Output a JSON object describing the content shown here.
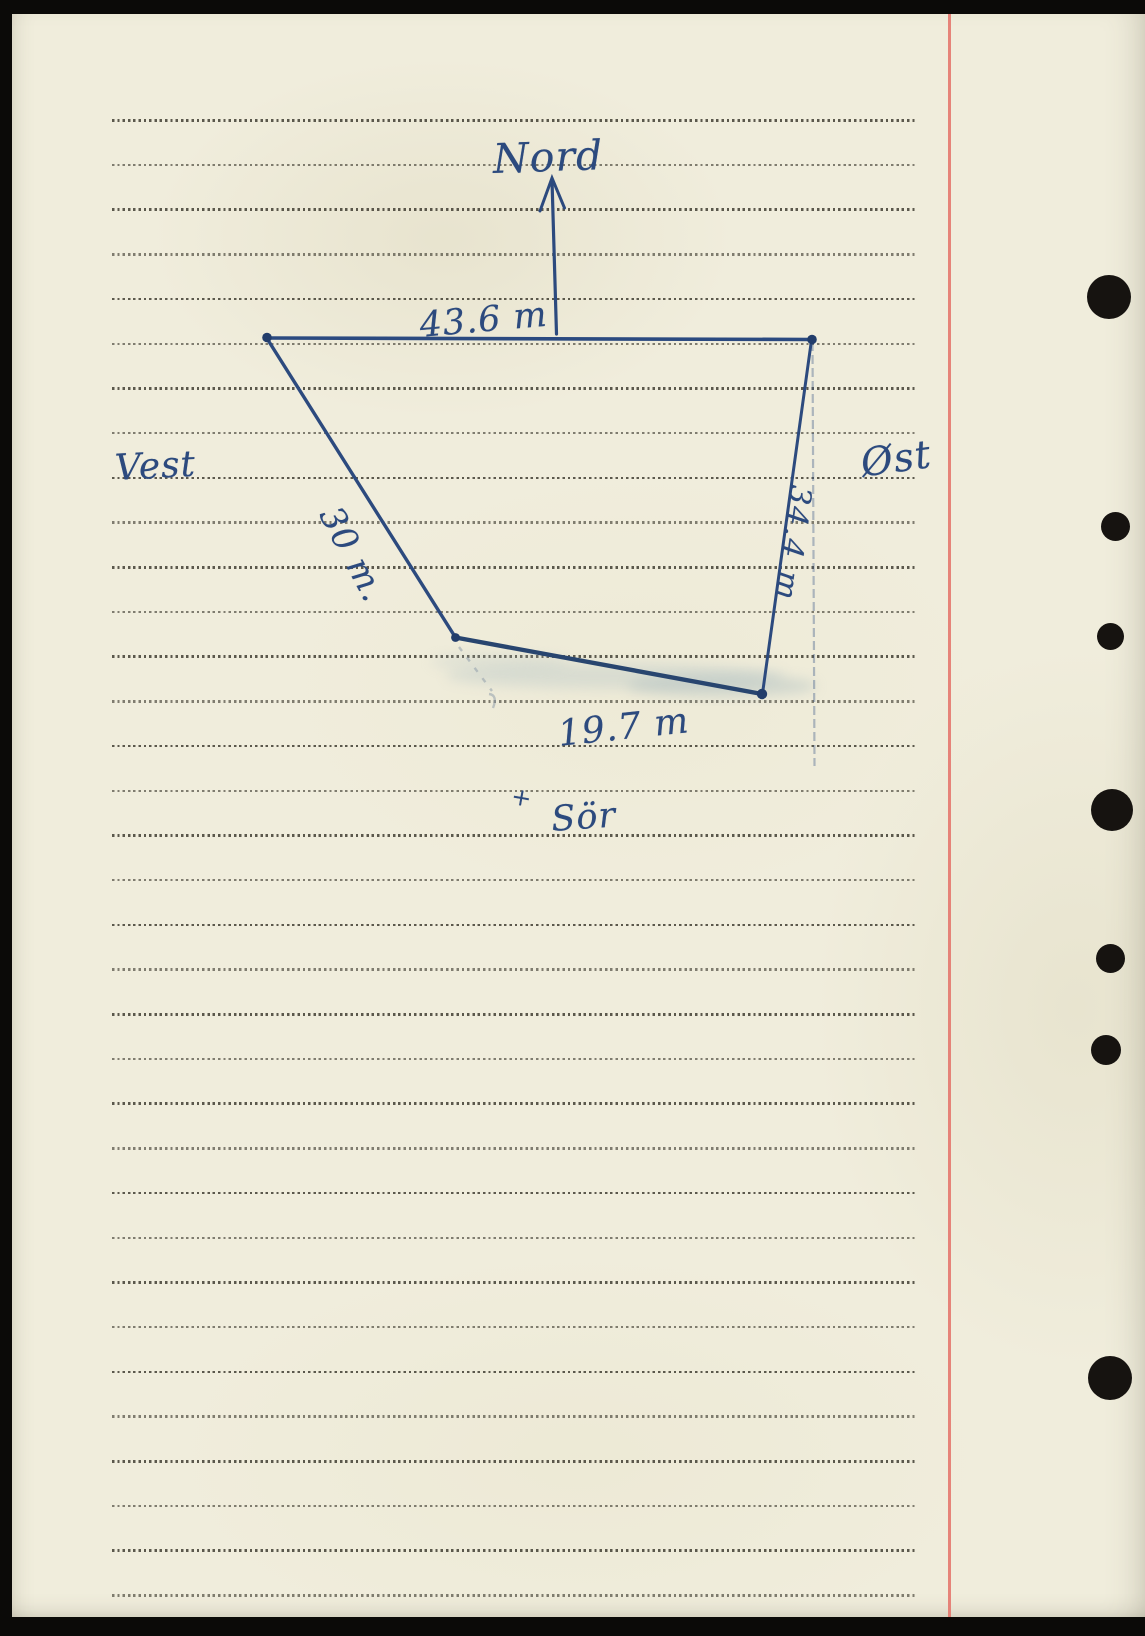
{
  "colors": {
    "paper": "#f0eddc",
    "ink": "#2c4a7e",
    "ink-dark": "#223d6b",
    "rule": "#3a372c",
    "margin": "#e4786e",
    "hole": "#161310",
    "smudge": "#a9bcc2",
    "pencil": "#93a0ac"
  },
  "sketch": {
    "compass": {
      "north": "Nord",
      "west": "Vest",
      "east": "Øst",
      "south": "Sör"
    },
    "measurements": {
      "north_side": "43.6 m",
      "west_side": "30 m.",
      "east_side": "34.4 m",
      "south_side": "19.7 m"
    },
    "tick_mark": "+",
    "icons": {
      "north_arrow_icon": "arrow-up"
    },
    "sides": [
      {
        "direction": "north",
        "length_m": 43.6
      },
      {
        "direction": "west",
        "length_m": 30
      },
      {
        "direction": "east",
        "length_m": 34.4
      },
      {
        "direction": "south",
        "length_m": 19.7
      }
    ]
  }
}
